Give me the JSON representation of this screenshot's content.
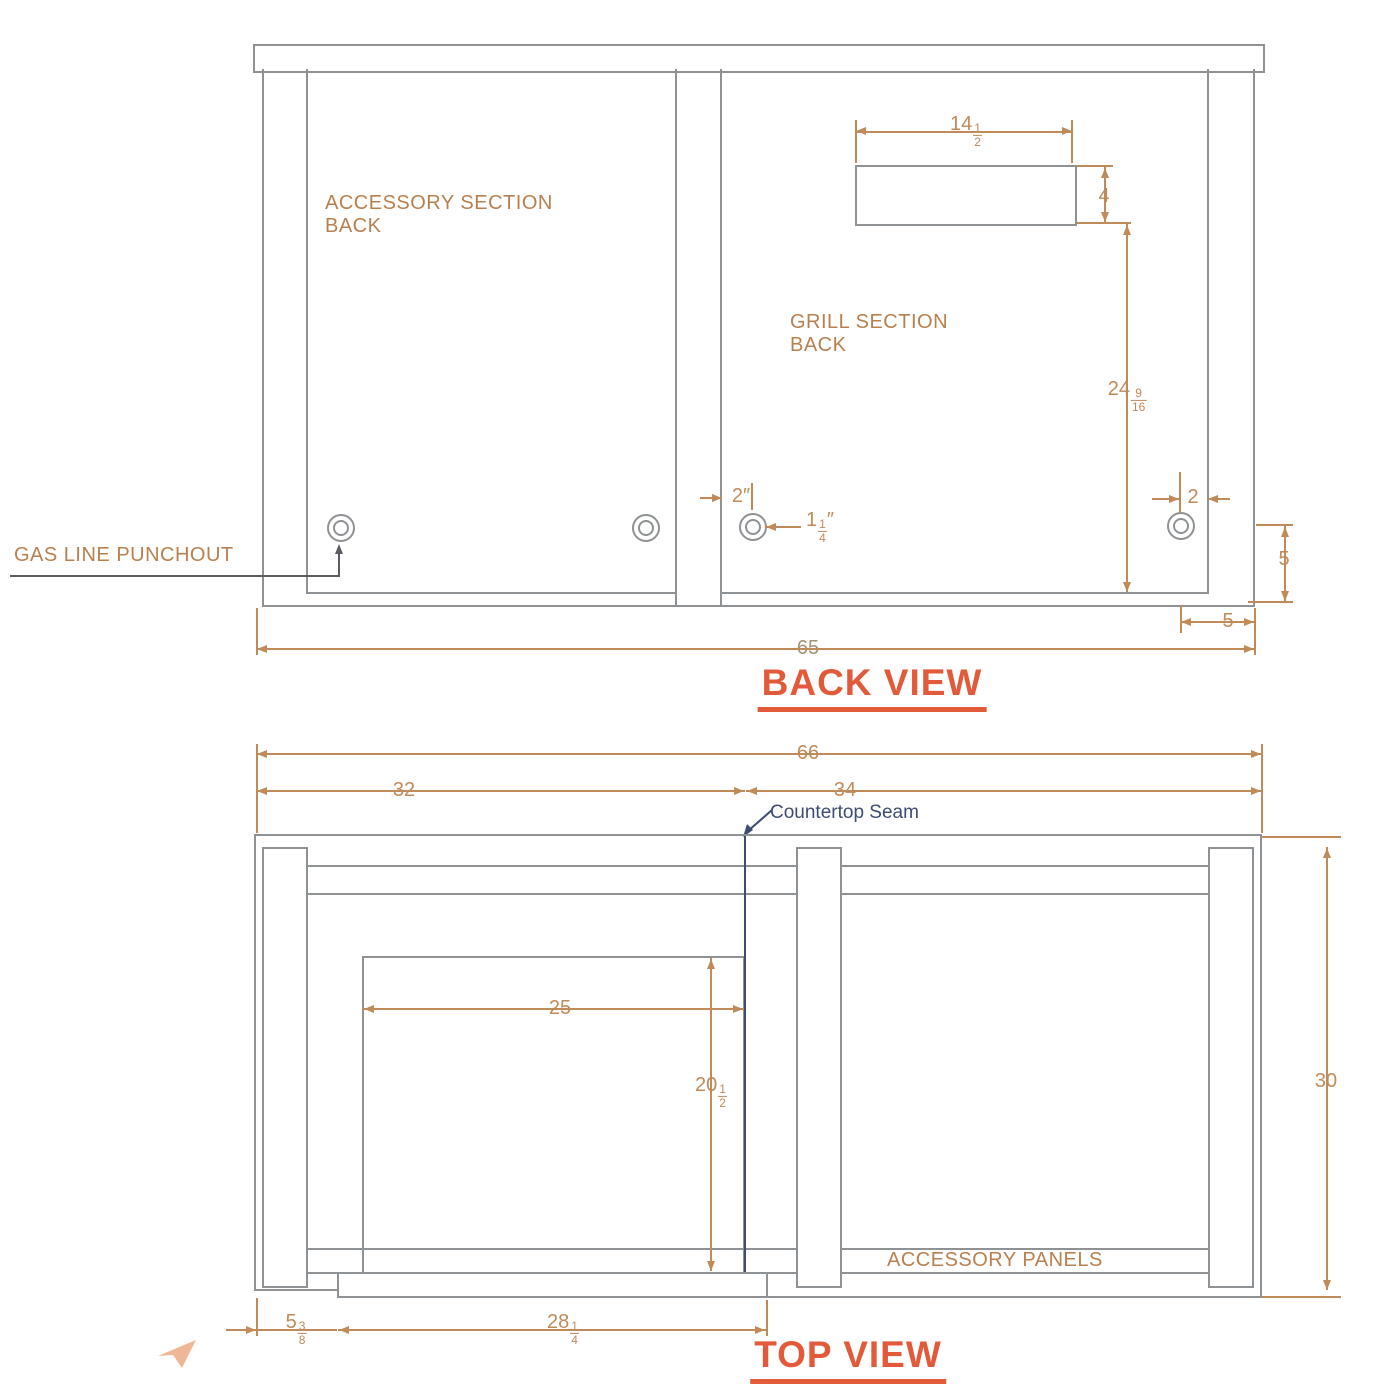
{
  "back_view": {
    "title": "BACK VIEW",
    "labels": {
      "accessory_section_line1": "ACCESSORY SECTION",
      "accessory_section_line2": "BACK",
      "grill_section_line1": "GRILL SECTION",
      "grill_section_line2": "BACK",
      "gas_line_punchout": "GAS LINE PUNCHOUT"
    },
    "dims": {
      "cutout_width": {
        "whole": "14",
        "num": "1",
        "den": "2"
      },
      "cutout_height": {
        "whole": "4"
      },
      "cutout_to_bottom": {
        "whole": "24",
        "num": "9",
        "den": "16"
      },
      "punchout_offset_grill": {
        "whole": "2",
        "suffix": "″"
      },
      "punchout_diameter": {
        "whole": "1",
        "num": "1",
        "den": "4",
        "suffix": "″"
      },
      "punchout_offset_right": {
        "whole": "2"
      },
      "punchout_to_bottom": {
        "whole": "5"
      },
      "punchout_to_edge": {
        "whole": "5"
      },
      "overall_width": {
        "whole": "65"
      }
    }
  },
  "top_view": {
    "title": "TOP VIEW",
    "labels": {
      "countertop_seam": "Countertop Seam",
      "accessory_panels": "ACCESSORY PANELS"
    },
    "dims": {
      "overall_width": {
        "whole": "66"
      },
      "accessory_section_width": {
        "whole": "32"
      },
      "grill_section_width": {
        "whole": "34"
      },
      "overall_depth": {
        "whole": "30"
      },
      "grill_cutout_width": {
        "whole": "25"
      },
      "grill_cutout_depth": {
        "whole": "20",
        "num": "1",
        "den": "2"
      },
      "front_left_offset": {
        "whole": "5",
        "num": "3",
        "den": "8"
      },
      "front_cutout_width": {
        "whole": "28",
        "num": "1",
        "den": "4"
      }
    }
  },
  "colors": {
    "dimension": "#c08a59",
    "structure": "#8f9295",
    "seam": "#3d4c72",
    "title": "#e25a3a"
  }
}
